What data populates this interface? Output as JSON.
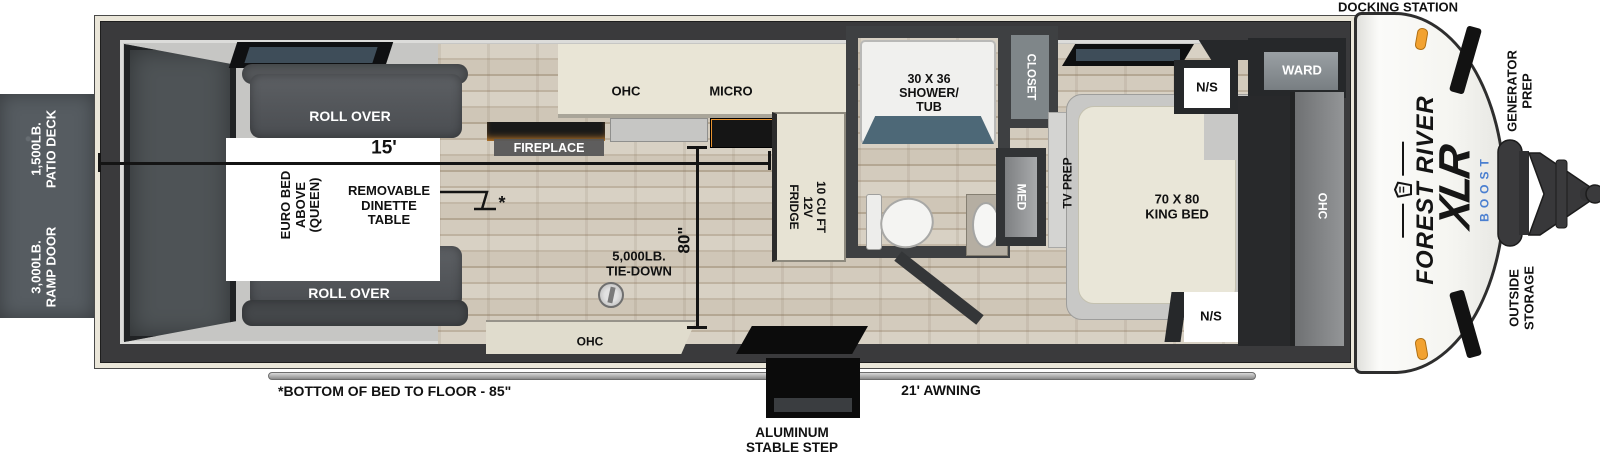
{
  "title": "Forest River XLR Boost travel trailer floorplan",
  "colors": {
    "shell_cream": "#eae6d9",
    "wall_dark": "#3a3a3c",
    "amber_glow": "#e8932f",
    "boost_blue": "#4a7fd0",
    "marker_light_orange": "#f2a231",
    "shower_rim_slate": "#4d6877"
  },
  "exterior": {
    "docking_station": "DOCKING STATION",
    "patio_deck": {
      "line1": "1,500LB.",
      "line2": "PATIO DECK"
    },
    "ramp_door": {
      "line1": "3,000LB.",
      "line2": "RAMP DOOR"
    },
    "generator_prep": {
      "line1": "GENERATOR",
      "line2": "PREP"
    },
    "outside_storage": {
      "line1": "OUTSIDE",
      "line2": "STORAGE"
    },
    "awning": "21' AWNING",
    "step": {
      "line1": "ALUMINUM",
      "line2": "STABLE STEP"
    },
    "bed_note": "*BOTTOM OF BED TO FLOOR - 85\""
  },
  "brand": {
    "name": "FOREST RIVER",
    "model": "XLR",
    "sub": "BOOST"
  },
  "garage": {
    "roll_over_top": "ROLL OVER",
    "roll_over_bottom": "ROLL OVER",
    "length_dim": "15'",
    "height_dim": "80\"",
    "euro_bed": {
      "line1": "EURO BED",
      "line2": "ABOVE",
      "line3": "(QUEEN)"
    },
    "dinette": {
      "line1": "REMOVABLE",
      "line2": "DINETTE",
      "line3": "TABLE"
    },
    "dinette_mark": "*",
    "tie_down": {
      "line1": "5,000LB.",
      "line2": "TIE-DOWN"
    },
    "fireplace": "FIREPLACE",
    "ohc_rear": "OHC"
  },
  "kitchen": {
    "ohc": "OHC",
    "micro": "MICRO",
    "fridge": {
      "line1": "10 CU FT",
      "line2": "12V",
      "line3": "FRIDGE"
    }
  },
  "bathroom": {
    "shower": {
      "line1": "30 X 36",
      "line2": "SHOWER/",
      "line3": "TUB"
    },
    "med": "MED"
  },
  "bedroom": {
    "closet": "CLOSET",
    "tv_prep": "TV PREP",
    "king_bed": {
      "line1": "70 X 80",
      "line2": "KING BED"
    },
    "ns_front": "N/S",
    "ns_rear": "N/S",
    "ward": "WARD",
    "ohc": "OHC"
  }
}
